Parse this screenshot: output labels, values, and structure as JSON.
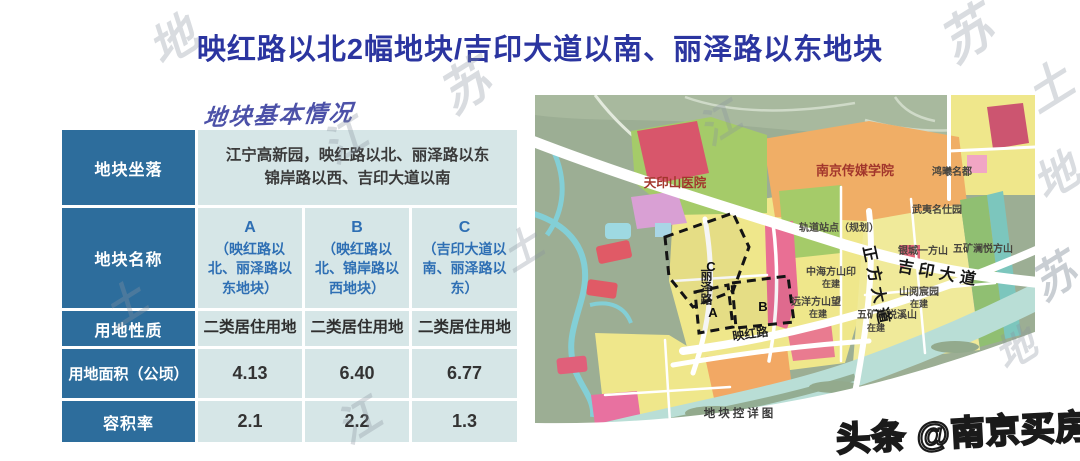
{
  "page": {
    "title": "映红路以北2幅地块/吉印大道以南、丽泽路以东地块",
    "section_header": "地块基本情况",
    "watermark_badge": "头条 @南京买房V"
  },
  "table": {
    "row_labels": {
      "location": "地块坐落",
      "name": "地块名称",
      "land_use": "用地性质",
      "area": "用地面积（公顷）",
      "far": "容积率"
    },
    "location_line1": "江宁高新园，映红路以北、丽泽路以东",
    "location_line2": "锦岸路以西、吉印大道以南",
    "parcels": [
      {
        "id": "A",
        "name": "（映红路以北、丽泽路以东地块）",
        "land_use": "二类居住用地",
        "area": "4.13",
        "far": "2.1"
      },
      {
        "id": "B",
        "name": "（映红路以北、锦岸路以西地块）",
        "land_use": "二类居住用地",
        "area": "6.40",
        "far": "2.2"
      },
      {
        "id": "C",
        "name": "（吉印大道以南、丽泽路以东）",
        "land_use": "二类居住用地",
        "area": "6.77",
        "far": "1.3"
      }
    ]
  },
  "map": {
    "caption": "地块控详图",
    "labels": {
      "hospital": "天印山医院",
      "college": "南京传媒学院",
      "metro_station": "轨道站点（规划）",
      "community_northeast": "鸿曦名都",
      "wuyi_mingshiyuan": "武夷名仕园",
      "yincheng_yifangshan": "银城一方山",
      "wukuang_fangshan": "五矿澜悦方山",
      "zhonghai_fangshanyin": "中海方山印",
      "yuanyang_fangshanwang": "远洋方山望",
      "shanyue_chenyuan": "山阅宸园",
      "wukuang_xishan": "五矿澜悦溪山",
      "under_construction": "在建",
      "road_zhengfang": "正方大道",
      "road_jiyin": "吉印大道",
      "road_lize": "丽泽路",
      "road_yinghong": "映红路",
      "parcel_a": "A",
      "parcel_b": "B",
      "parcel_c": "C"
    }
  },
  "colors": {
    "title_blue": "#2b35a0",
    "table_header_blue": "#2d6d9c",
    "table_cell_bg": "#d6e6e7",
    "parcel_name_blue": "#2e6fb4"
  },
  "watermarks": [
    "地",
    "苏",
    "江",
    "土",
    "土",
    "江",
    "苏",
    "土",
    "地",
    "苏",
    "江",
    "地"
  ]
}
